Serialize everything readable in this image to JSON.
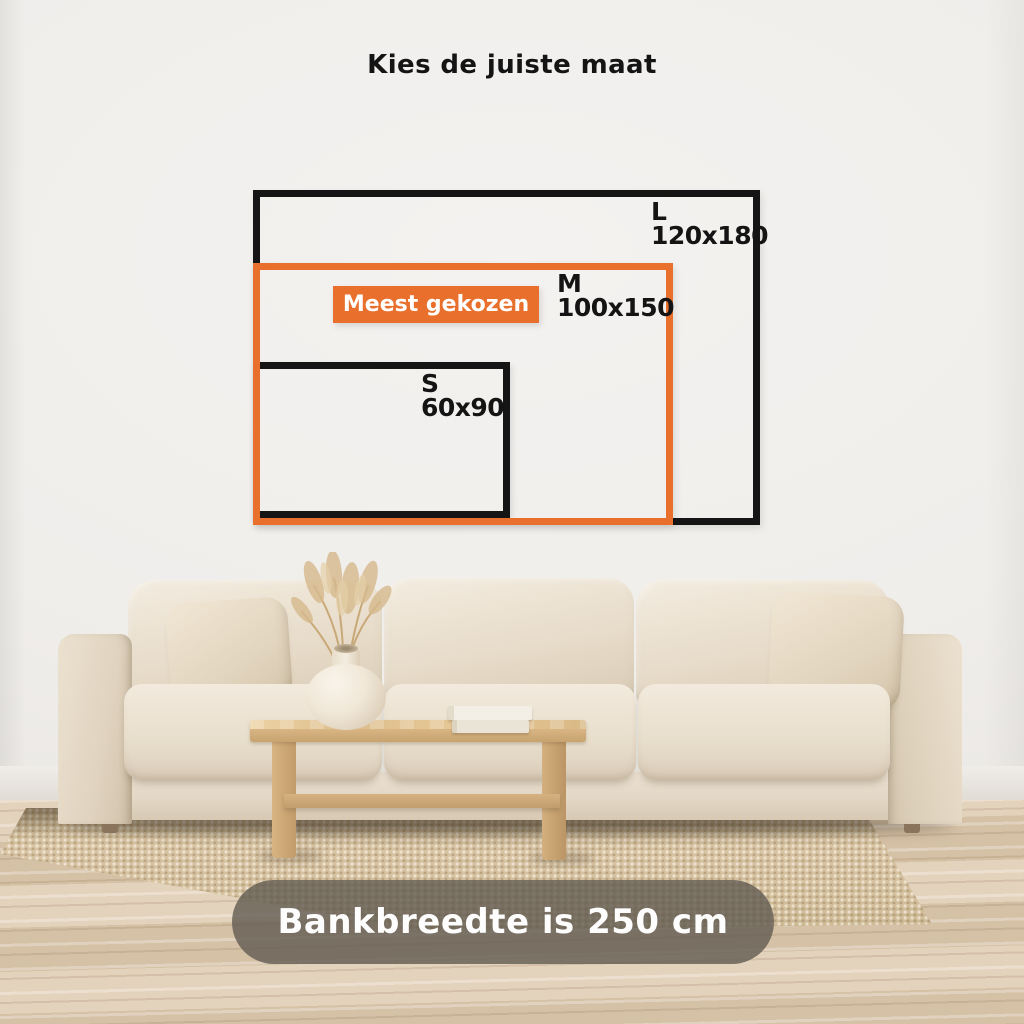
{
  "title": "Kies de juiste maat",
  "size_guide": {
    "l": {
      "label": "L",
      "dimensions": "120x180"
    },
    "m": {
      "label": "M",
      "dimensions": "100x150",
      "badge": "Meest gekozen"
    },
    "s": {
      "label": "S",
      "dimensions": "60x90"
    }
  },
  "banner": {
    "text": "Bankbreedte is 250 cm"
  },
  "colors": {
    "accent_orange": "#E8702C",
    "frame_black": "#151515",
    "banner_background": "rgba(95,89,80,0.78)",
    "banner_text": "#FFFFFF",
    "wall": "#F0EEEB"
  }
}
